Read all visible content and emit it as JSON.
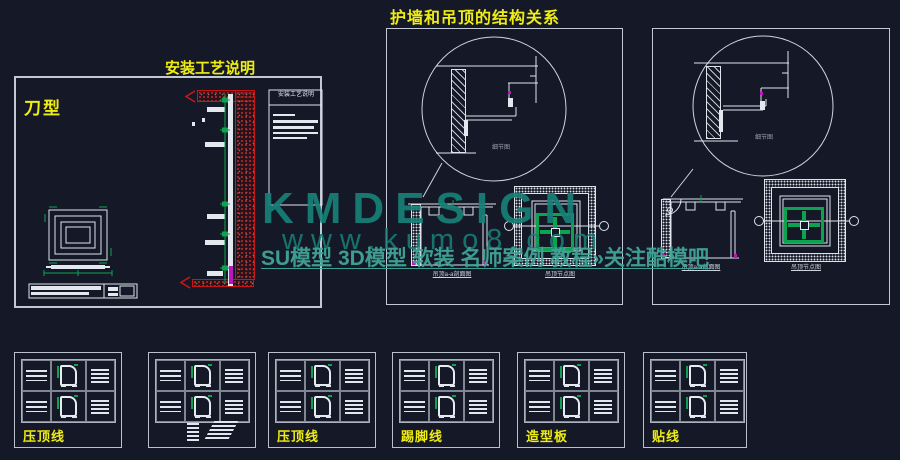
{
  "page": {
    "title": "护墙和吊顶的结构关系",
    "colors": {
      "background": "#151927",
      "line": "#dfe4ec",
      "accent_yellow": "#f0ed12",
      "accent_green": "#0ca24f",
      "accent_red": "#c81414",
      "accent_magenta": "#bb16bb",
      "watermark_teal": "#178076"
    }
  },
  "left_panel": {
    "heading": "安装工艺说明",
    "type_label": "刀型",
    "legend_title": "安装工艺说明"
  },
  "middle_panel": {
    "detail_label": "细节图",
    "section_caption": "吊顶a-a剖面图",
    "plan_caption": "吊顶节点图"
  },
  "right_panel": {
    "detail_label": "细节图",
    "section_caption": "吊顶a-a剖面图",
    "plan_caption": "吊顶节点图"
  },
  "bottom_panels": [
    {
      "label": "压顶线"
    },
    {
      "label": ""
    },
    {
      "label": "压顶线"
    },
    {
      "label": "踢脚线"
    },
    {
      "label": "造型板"
    },
    {
      "label": "贴线"
    }
  ],
  "watermark": {
    "line1": "KMDESIGN",
    "line2": "www.kumo8.com",
    "line3": "SU模型 3D模型 软装 名师案例 教程»关注酷模吧"
  }
}
